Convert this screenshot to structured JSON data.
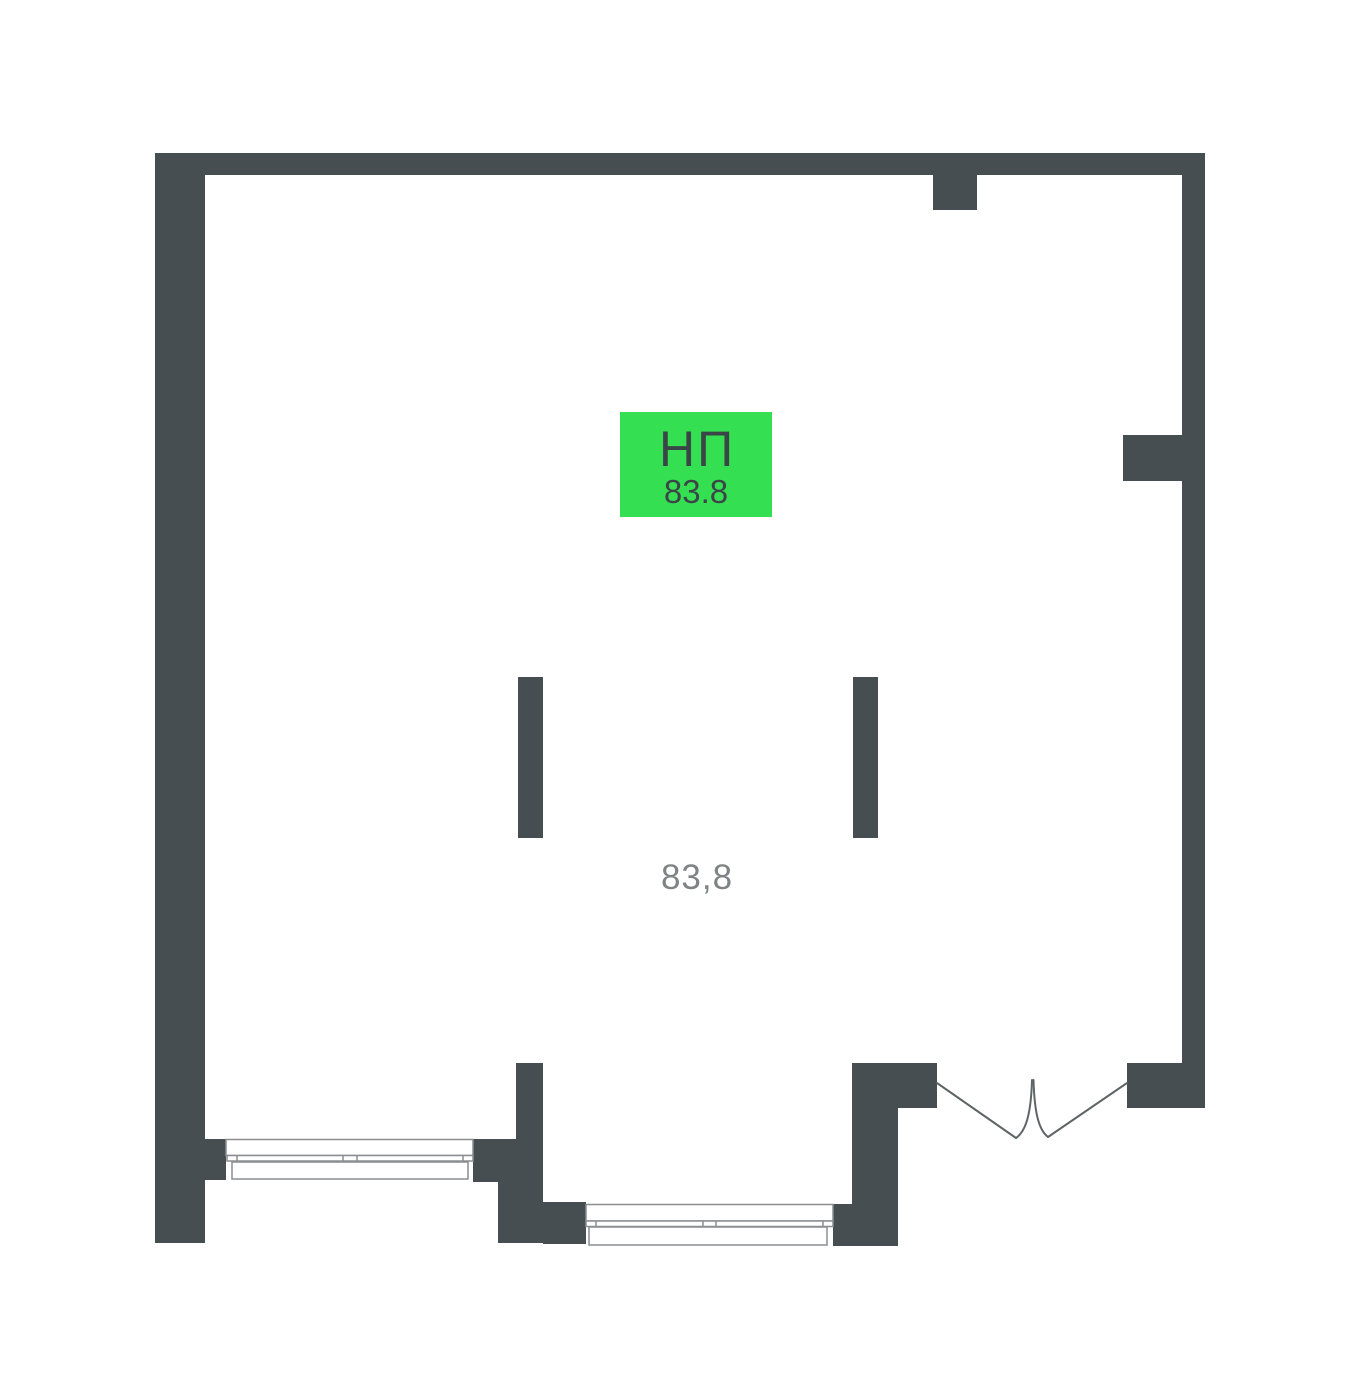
{
  "colors": {
    "wall": "#464e51",
    "accent": "#34e051",
    "badge_text": "#3b4547",
    "area_text": "#7e8385",
    "window_line": "#8a8e90",
    "door_line": "#5f6567",
    "background": "#ffffff"
  },
  "unit": {
    "type_label": "НП",
    "badge_area": "83.8",
    "room_area": "83,8"
  }
}
